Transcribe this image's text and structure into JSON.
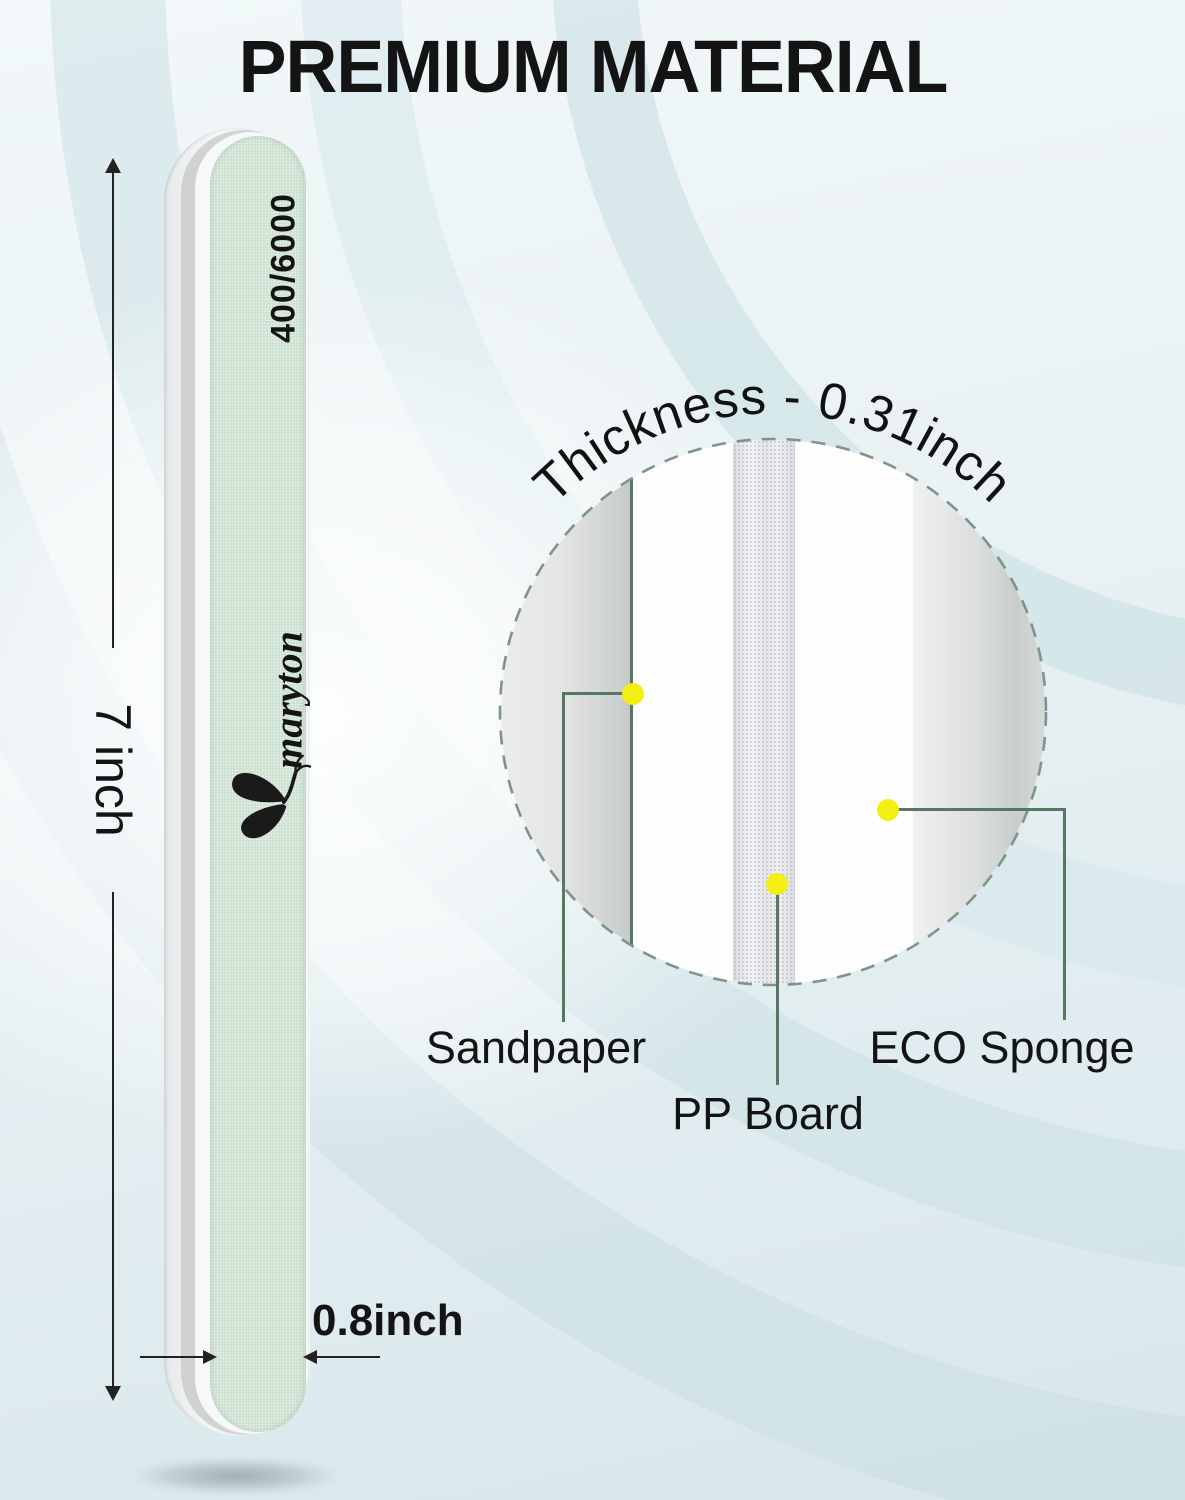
{
  "title": "PREMIUM MATERIAL",
  "product": {
    "brand": "maryton",
    "grit_label": "400/6000"
  },
  "dimensions": {
    "length_label": "7 inch",
    "width_label": "0.8inch",
    "thickness_label": "Thickness - 0.31inch"
  },
  "materials": {
    "sandpaper": "Sandpaper",
    "pp_board": "PP Board",
    "eco_sponge": "ECO Sponge"
  },
  "colors": {
    "file_face_green": "#cde1d1",
    "marker_yellow": "#f3ee14",
    "callout_green": "#567760",
    "background_blue": "#e3eef1"
  }
}
